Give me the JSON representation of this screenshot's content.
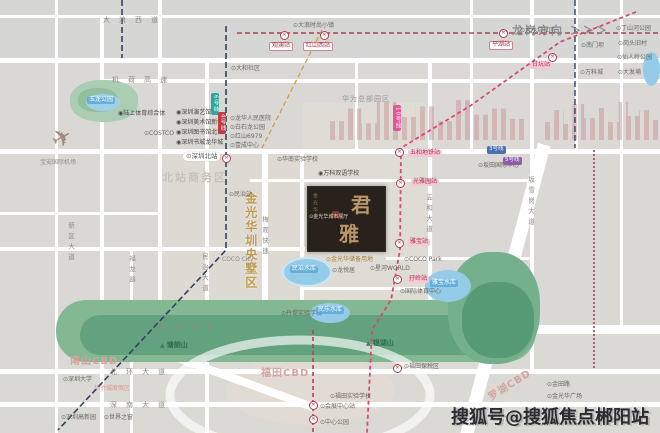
{
  "meta": {
    "watermark": "搜狐号@搜狐焦点郴阳站",
    "direction": "龙岗方向 ＞＞＞"
  },
  "project": {
    "char1": "君",
    "char2": "雅",
    "brand": "金光华",
    "sub": "城市展厅",
    "district": "金光华圳央墅区"
  },
  "colors": {
    "metro_pink": "#d84a6f",
    "metro_red": "#b5414e",
    "metro_navy": "#33415f",
    "gold": "#bf9a4d",
    "green": "#83b893",
    "water": "#93cbe9"
  },
  "map_labels": [
    {
      "id": "airport-label",
      "text": "宝安国际机场",
      "x": 40,
      "y": 160,
      "cls": "tiny-gray"
    },
    {
      "id": "road-dalangxidao",
      "text": "大浪西道",
      "x": 103,
      "y": 16,
      "cls": "road-h"
    },
    {
      "id": "road-jihe-expwy",
      "text": "机荷高速",
      "x": 112,
      "y": 76,
      "cls": "road-h"
    },
    {
      "id": "poi-dalang-fashion-town",
      "text": "⊙大浪时尚小镇",
      "x": 293,
      "y": 23,
      "cls": "poi"
    },
    {
      "id": "poi-dahe-village",
      "text": "⊙大和社区",
      "x": 231,
      "y": 66,
      "cls": "poi"
    },
    {
      "id": "station-tag-guanlan",
      "text": "观澜站",
      "x": 269,
      "y": 42,
      "cls": "red-tag"
    },
    {
      "id": "station-tag-hongshanxi",
      "text": "红山西站",
      "x": 303,
      "y": 42,
      "cls": "red-tag"
    },
    {
      "id": "station-tag-pinghu",
      "text": "平湖站",
      "x": 489,
      "y": 41,
      "cls": "red-tag"
    },
    {
      "id": "station-tag-gankeng",
      "text": "甘坑站",
      "x": 530,
      "y": 62,
      "cls": "pink-tag"
    },
    {
      "id": "poi-dashuikeng",
      "text": "⊙大水坑社区",
      "x": 520,
      "y": 28,
      "cls": "poi"
    },
    {
      "id": "poi-dingshanhe-park",
      "text": "⊙丁山河公园",
      "x": 616,
      "y": 26,
      "cls": "poi"
    },
    {
      "id": "poi-nanmenba",
      "text": "⊙南门坝",
      "x": 581,
      "y": 43,
      "cls": "poi"
    },
    {
      "id": "poi-gangtou-village",
      "text": "⊙岗头旧村",
      "x": 618,
      "y": 41,
      "cls": "poi"
    },
    {
      "id": "poi-xianrenling-park",
      "text": "⊙仙人岭公园",
      "x": 617,
      "y": 55,
      "cls": "poi"
    },
    {
      "id": "poi-wankecheng",
      "text": "⊙万科城",
      "x": 580,
      "y": 70,
      "cls": "poi"
    },
    {
      "id": "poi-dafabu",
      "text": "⊙大发埔",
      "x": 618,
      "y": 70,
      "cls": "poi"
    },
    {
      "id": "huawei-hq-label",
      "text": "华为总部园区",
      "x": 342,
      "y": 95,
      "cls": "gray-md"
    },
    {
      "id": "poi-land-sports-complex",
      "text": "◉陆上体育综合体",
      "x": 118,
      "y": 111,
      "cls": "poi-dark"
    },
    {
      "id": "venue-yanyi-hall",
      "text": "◉深圳演艺馆",
      "x": 176,
      "y": 110,
      "cls": "poi-dark"
    },
    {
      "id": "venue-art-museum",
      "text": "◉深圳美术馆新馆",
      "x": 176,
      "y": 120,
      "cls": "poi-dark"
    },
    {
      "id": "venue-library-north",
      "text": "◉深圳图书馆北馆",
      "x": 176,
      "y": 130,
      "cls": "poi-dark"
    },
    {
      "id": "venue-book-city",
      "text": "◉深圳书城龙华城",
      "x": 176,
      "y": 140,
      "cls": "poi-dark"
    },
    {
      "id": "poi-costco",
      "text": "⊙COSTCO",
      "x": 144,
      "y": 131,
      "cls": "poi"
    },
    {
      "id": "poi-longhua-hospital",
      "text": "⊙龙华人民医院",
      "x": 230,
      "y": 116,
      "cls": "poi"
    },
    {
      "id": "poi-baishilong-park",
      "text": "⊙白石龙公园",
      "x": 230,
      "y": 125,
      "cls": "poi"
    },
    {
      "id": "poi-hongshan6979",
      "text": "⊙红山6979",
      "x": 230,
      "y": 134,
      "cls": "poi"
    },
    {
      "id": "poi-yicheng-center",
      "text": "⊙壹成中心",
      "x": 230,
      "y": 143,
      "cls": "poi"
    },
    {
      "id": "station-tag-shenzhenbei",
      "text": "⊙深圳北站",
      "x": 183,
      "y": 152,
      "cls": "white-pill"
    },
    {
      "id": "area-beizhan-cbd",
      "text": "北站商务区",
      "x": 162,
      "y": 172,
      "cls": "area-big"
    },
    {
      "id": "park-yulong",
      "text": "玉龙公园",
      "x": 87,
      "y": 97,
      "cls": "water-label"
    },
    {
      "id": "poi-huanan-school",
      "text": "⊙华南实验学校",
      "x": 277,
      "y": 157,
      "cls": "poi"
    },
    {
      "id": "poi-wanke-school",
      "text": "◉万科双语学校",
      "x": 318,
      "y": 171,
      "cls": "poi-dark"
    },
    {
      "id": "station-tag-wuhe",
      "text": "五和地铁站",
      "x": 408,
      "y": 150,
      "cls": "pink-tag"
    },
    {
      "id": "station-tag-guangyayuan",
      "text": "光雅园站",
      "x": 411,
      "y": 179,
      "cls": "pink-tag"
    },
    {
      "id": "station-tag-yabao",
      "text": "雅宝站",
      "x": 408,
      "y": 239,
      "cls": "pink-tag"
    },
    {
      "id": "station-tag-maling",
      "text": "孖岭站",
      "x": 407,
      "y": 276,
      "cls": "pink-tag"
    },
    {
      "id": "poi-coco-park",
      "text": "⊙COCO Park",
      "x": 404,
      "y": 257,
      "cls": "poi"
    },
    {
      "id": "poi-xinghe-world",
      "text": "⊙星河WORLD",
      "x": 370,
      "y": 266,
      "cls": "poi"
    },
    {
      "id": "poi-intl-sports-center",
      "text": "⊙国际体育中心",
      "x": 400,
      "y": 289,
      "cls": "poi"
    },
    {
      "id": "poi-jgh-reserved-land",
      "text": "⊙金光华储备用地",
      "x": 326,
      "y": 257,
      "cls": "gold-label"
    },
    {
      "id": "poi-longyueju",
      "text": "⊙龙悦居",
      "x": 332,
      "y": 268,
      "cls": "poi"
    },
    {
      "id": "poi-coco-city",
      "text": "COCO City",
      "x": 222,
      "y": 257,
      "cls": "tiny-gray"
    },
    {
      "id": "poi-minzhi-station",
      "text": "⊙民治站",
      "x": 229,
      "y": 192,
      "cls": "poi"
    },
    {
      "id": "poi-bantian-intl-center",
      "text": "⊙坂田国际中心",
      "x": 478,
      "y": 163,
      "cls": "poi"
    },
    {
      "id": "road-meiguan-expwy",
      "text": "梅观快速",
      "x": 260,
      "y": 216,
      "cls": "road-v"
    },
    {
      "id": "road-fulong",
      "text": "福龙路",
      "x": 127,
      "y": 255,
      "cls": "road-v"
    },
    {
      "id": "road-xinqu-av",
      "text": "新区大道",
      "x": 66,
      "y": 222,
      "cls": "road-v"
    },
    {
      "id": "road-minzhi-av",
      "text": "民治大道",
      "x": 200,
      "y": 253,
      "cls": "road-v"
    },
    {
      "id": "road-wuhe-av",
      "text": "五和大道",
      "x": 424,
      "y": 194,
      "cls": "road-v"
    },
    {
      "id": "road-banxuegang-av",
      "text": "坂雪岗大道",
      "x": 526,
      "y": 176,
      "cls": "road-v"
    },
    {
      "id": "poi-showroom",
      "text": "⊙金光华城市展厅",
      "x": 309,
      "y": 215,
      "cls": "poi-light"
    },
    {
      "id": "mountain-tanglang",
      "text": "塘朗山",
      "x": 160,
      "y": 341,
      "cls": "mountain"
    },
    {
      "id": "mountain-yinhu",
      "text": "银湖山",
      "x": 366,
      "y": 339,
      "cls": "mountain"
    },
    {
      "id": "reservoir-minzhi",
      "text": "民治水库",
      "x": 290,
      "y": 266,
      "cls": "water-label"
    },
    {
      "id": "reservoir-yabao",
      "text": "雅宝水库",
      "x": 430,
      "y": 280,
      "cls": "water-label"
    },
    {
      "id": "reservoir-minle",
      "text": "民乐水库",
      "x": 316,
      "y": 307,
      "cls": "water-label"
    },
    {
      "id": "poi-dandi-school",
      "text": "⊙丹堤实验学校",
      "x": 281,
      "y": 311,
      "cls": "poi"
    },
    {
      "id": "road-nanping-expwy",
      "text": "南坪快速",
      "x": 158,
      "y": 323,
      "cls": "road-h"
    },
    {
      "id": "area-nanshan-cbd",
      "text": "南山CBD",
      "x": 70,
      "y": 356,
      "cls": "cbd-pink"
    },
    {
      "id": "area-futian-cbd",
      "text": "福田CBD",
      "x": 261,
      "y": 368,
      "cls": "cbd-pink"
    },
    {
      "id": "area-luohu-cbd",
      "text": "罗湖CBD",
      "x": 486,
      "y": 380,
      "cls": "cbd-pink",
      "rot": -32
    },
    {
      "id": "road-beihuan-av",
      "text": "北环大道",
      "x": 110,
      "y": 368,
      "cls": "road-h"
    },
    {
      "id": "road-shennan-av",
      "text": "深南大道",
      "x": 110,
      "y": 401,
      "cls": "road-h"
    },
    {
      "id": "poi-shenzhen-univ",
      "text": "⊙深圳大学",
      "x": 63,
      "y": 377,
      "cls": "poi"
    },
    {
      "id": "poi-oct",
      "text": "华侨城度假区",
      "x": 94,
      "y": 386,
      "cls": "pink-small"
    },
    {
      "id": "poi-hi-tech-park",
      "text": "⊙深圳高新园",
      "x": 61,
      "y": 415,
      "cls": "poi"
    },
    {
      "id": "poi-window-of-world",
      "text": "⊙世界之窗",
      "x": 104,
      "y": 415,
      "cls": "poi"
    },
    {
      "id": "poi-futian-school",
      "text": "⊙福田实验学校",
      "x": 330,
      "y": 394,
      "cls": "poi"
    },
    {
      "id": "station-tag-convention",
      "text": "⊙会展中心站",
      "x": 320,
      "y": 404,
      "cls": "poi"
    },
    {
      "id": "poi-center-park",
      "text": "⊙中心公园",
      "x": 320,
      "y": 420,
      "cls": "poi"
    },
    {
      "id": "poi-futian-bonded",
      "text": "⊙福田保税区",
      "x": 404,
      "y": 364,
      "cls": "poi"
    },
    {
      "id": "poi-jintian-rd",
      "text": "⊙金田路",
      "x": 547,
      "y": 382,
      "cls": "poi"
    },
    {
      "id": "poi-jgh-plaza",
      "text": "⊙金光华广场",
      "x": 547,
      "y": 394,
      "cls": "poi"
    }
  ],
  "station_icons": [
    {
      "x": 280,
      "y": 31
    },
    {
      "x": 320,
      "y": 31
    },
    {
      "x": 499,
      "y": 29
    },
    {
      "x": 548,
      "y": 53
    },
    {
      "x": 395,
      "y": 148
    },
    {
      "x": 396,
      "y": 179
    },
    {
      "x": 395,
      "y": 239
    },
    {
      "x": 393,
      "y": 275
    },
    {
      "x": 222,
      "y": 154
    },
    {
      "x": 309,
      "y": 401
    },
    {
      "x": 309,
      "y": 415
    },
    {
      "x": 393,
      "y": 364
    }
  ],
  "line_badges": [
    {
      "text": "6号线",
      "x": 211,
      "y": 93,
      "color": "#2aa7a0",
      "vertical": true
    },
    {
      "text": "4号线",
      "x": 218,
      "y": 112,
      "color": "#c23c45",
      "vertical": true
    },
    {
      "text": "10号线",
      "x": 393,
      "y": 105,
      "color": "#e0589a",
      "vertical": true
    },
    {
      "text": "3号线",
      "x": 487,
      "y": 146,
      "color": "#4a6fb5",
      "vertical": false
    },
    {
      "text": "5号线",
      "x": 503,
      "y": 157,
      "color": "#8f5ca8",
      "vertical": false
    }
  ]
}
